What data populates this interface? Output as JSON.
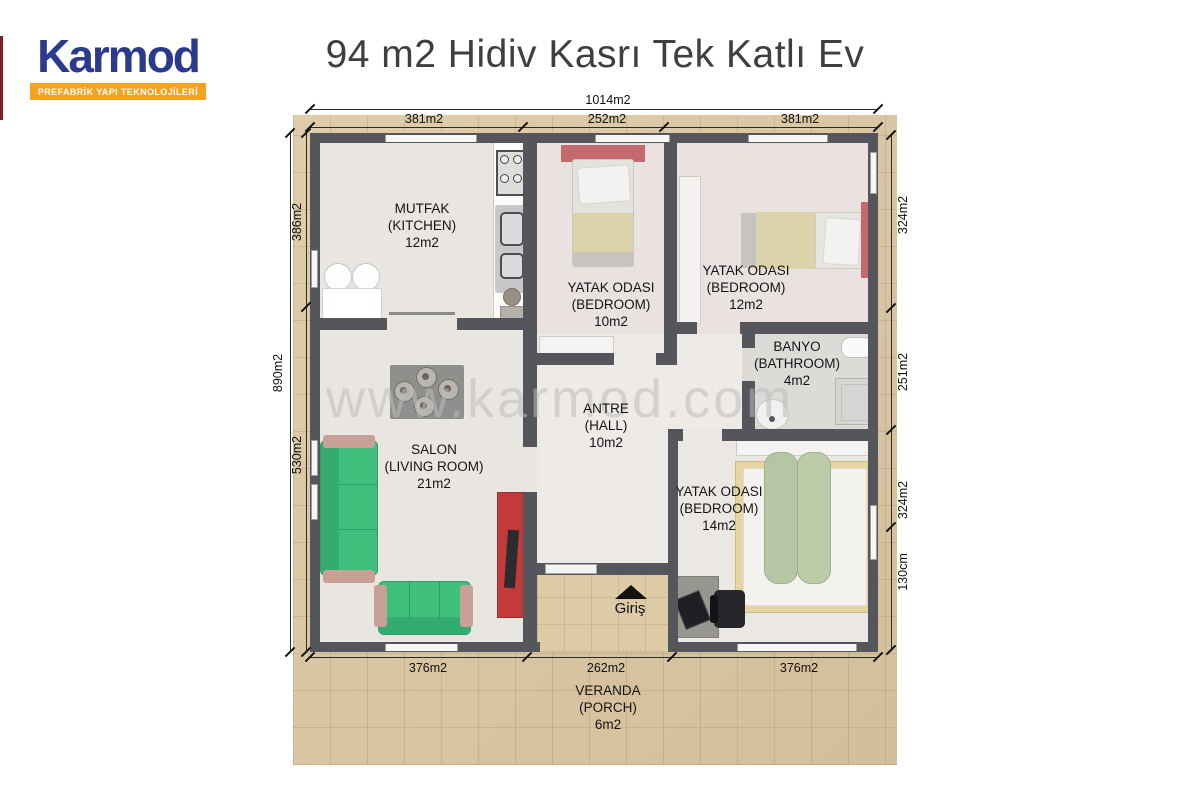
{
  "logo": {
    "brand": "Karmod",
    "tagline": "PREFABRİK YAPI TEKNOLOJİLERİ"
  },
  "title": "94 m2 Hidiv Kasrı Tek Katlı Ev",
  "watermark": "www.karmod.com",
  "entrance": {
    "label": "Giriş"
  },
  "rooms": [
    {
      "name_tr": "MUTFAK",
      "name_en": "(KITCHEN)",
      "area": "12m2"
    },
    {
      "name_tr": "YATAK ODASI",
      "name_en": "(BEDROOM)",
      "area": "10m2"
    },
    {
      "name_tr": "YATAK ODASI",
      "name_en": "(BEDROOM)",
      "area": "12m2"
    },
    {
      "name_tr": "BANYO",
      "name_en": "(BATHROOM)",
      "area": "4m2"
    },
    {
      "name_tr": "ANTRE",
      "name_en": "(HALL)",
      "area": "10m2"
    },
    {
      "name_tr": "SALON",
      "name_en": "(LIVING ROOM)",
      "area": "21m2"
    },
    {
      "name_tr": "YATAK ODASI",
      "name_en": "(BEDROOM)",
      "area": "14m2"
    },
    {
      "name_tr": "VERANDA",
      "name_en": "(PORCH)",
      "area": "6m2"
    }
  ],
  "dimensions": {
    "top_total": "1014m2",
    "top_segments": [
      "381m2",
      "252m2",
      "381m2"
    ],
    "left_total": "890m2",
    "left_segments": [
      "386m2",
      "530m2"
    ],
    "right_segments": [
      "324m2",
      "251m2",
      "324m2",
      "130cm"
    ],
    "bottom_segments": [
      "376m2",
      "262m2",
      "376m2"
    ]
  },
  "colors": {
    "brand_blue": "#2c3a8e",
    "brand_orange": "#f6a21c",
    "wall": "#55565c",
    "porch_tile": "#dbc7a2",
    "sofa_green": "#3ec07c",
    "tv_unit_red": "#c23a3a",
    "headboard_pink": "#c4696e"
  }
}
